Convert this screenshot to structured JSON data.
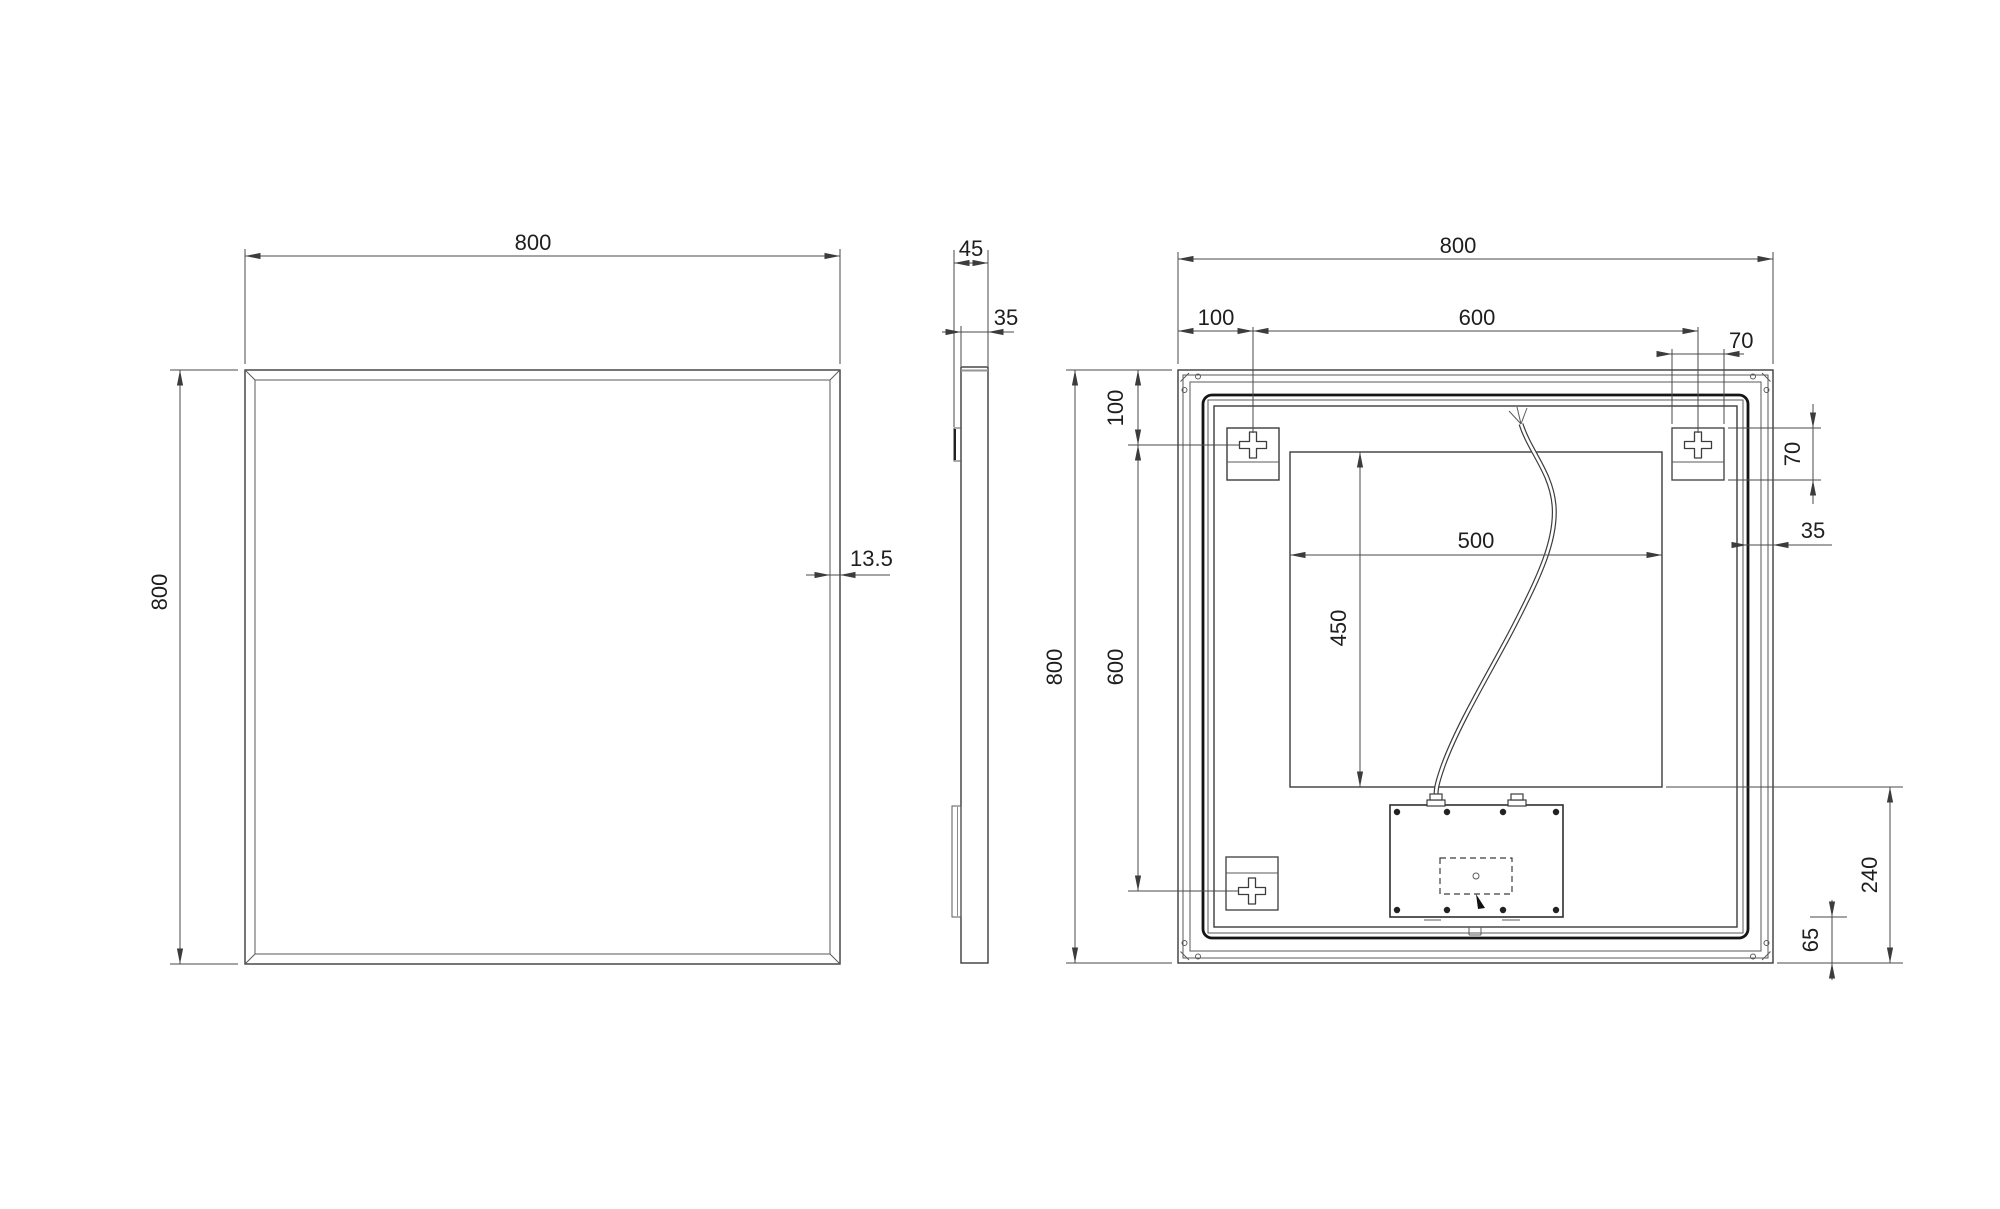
{
  "drawing": {
    "type": "technical-orthographic-views",
    "subject": "wall mirror with backlight and junction box",
    "front": {
      "width": "800",
      "height": "800",
      "frame_width": "13.5"
    },
    "side": {
      "total_depth": "45",
      "body_depth": "35"
    },
    "back": {
      "width": "800",
      "height": "800",
      "bracket_offset_top": "100",
      "bracket_spacing_top": "600",
      "bracket_plate_width": "70",
      "bracket_plate_height": "70",
      "frame_margin": "35",
      "bracket_offset_left": "100",
      "bracket_spacing_left": "600",
      "cutout_width": "500",
      "cutout_height": "450",
      "box_zone_height": "240",
      "box_bottom_offset": "65"
    }
  }
}
